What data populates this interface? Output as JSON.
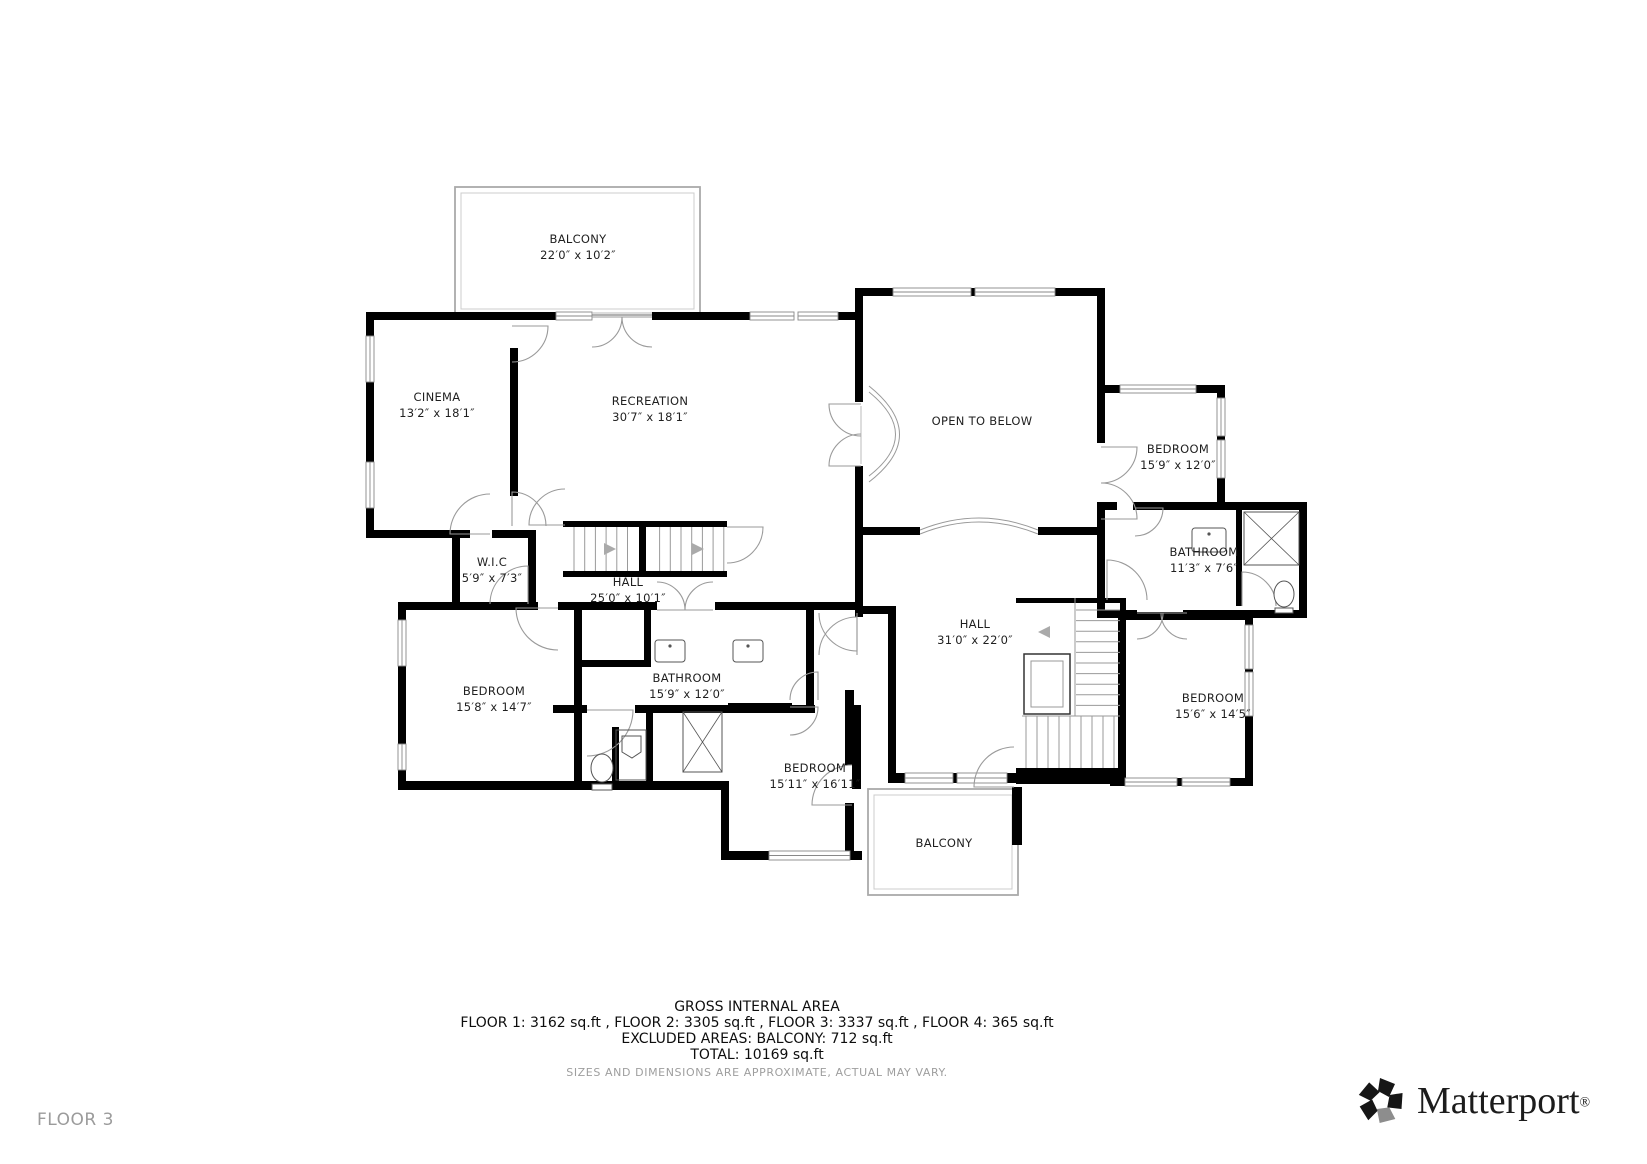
{
  "page": {
    "background": "#ffffff"
  },
  "floor_label": "FLOOR 3",
  "rooms": [
    {
      "id": "balcony-top",
      "name": "BALCONY",
      "dims": "22′0″ x 10′2″",
      "cx": 578,
      "y1": 243,
      "y2": 259
    },
    {
      "id": "cinema",
      "name": "CINEMA",
      "dims": "13′2″ x 18′1″",
      "cx": 437,
      "y1": 401,
      "y2": 417
    },
    {
      "id": "recreation",
      "name": "RECREATION",
      "dims": "30′7″ x 18′1″",
      "cx": 650,
      "y1": 405,
      "y2": 421
    },
    {
      "id": "open-to-below",
      "name": "OPEN TO BELOW",
      "dims": null,
      "cx": 982,
      "y1": 425,
      "y2": null
    },
    {
      "id": "bedroom-top-right",
      "name": "BEDROOM",
      "dims": "15′9″ x 12′0″",
      "cx": 1178,
      "y1": 453,
      "y2": 469
    },
    {
      "id": "wic",
      "name": "W.I.C",
      "dims": "5′9″ x 7′3″",
      "cx": 492,
      "y1": 566,
      "y2": 582
    },
    {
      "id": "hall-upper",
      "name": "HALL",
      "dims": "25′0″ x 10′1″",
      "cx": 628,
      "y1": 586,
      "y2": 602
    },
    {
      "id": "bathroom-top-right",
      "name": "BATHROOM",
      "dims": "11′3″ x 7′6″",
      "cx": 1204,
      "y1": 556,
      "y2": 572
    },
    {
      "id": "hall-main",
      "name": "HALL",
      "dims": "31′0″ x 22′0″",
      "cx": 975,
      "y1": 628,
      "y2": 644
    },
    {
      "id": "bedroom-left",
      "name": "BEDROOM",
      "dims": "15′8″ x 14′7″",
      "cx": 494,
      "y1": 695,
      "y2": 711
    },
    {
      "id": "bathroom-center",
      "name": "BATHROOM",
      "dims": "15′9″ x 12′0″",
      "cx": 687,
      "y1": 682,
      "y2": 698
    },
    {
      "id": "bedroom-bottom-right",
      "name": "BEDROOM",
      "dims": "15′6″ x 14′5″",
      "cx": 1213,
      "y1": 702,
      "y2": 718
    },
    {
      "id": "bedroom-bottom",
      "name": "BEDROOM",
      "dims": "15′11″ x 16′11″",
      "cx": 815,
      "y1": 772,
      "y2": 788
    },
    {
      "id": "balcony-bottom",
      "name": "BALCONY",
      "dims": null,
      "cx": 944,
      "y1": 847,
      "y2": null
    }
  ],
  "footer": {
    "title": "GROSS INTERNAL AREA",
    "line_floors": "FLOOR 1: 3162 sq.ft , FLOOR 2: 3305 sq.ft , FLOOR 3: 3337 sq.ft , FLOOR 4: 365 sq.ft",
    "line_excluded": "EXCLUDED AREAS: BALCONY: 712 sq.ft",
    "line_total": "TOTAL: 10169 sq.ft",
    "disclaimer": "SIZES AND DIMENSIONS ARE APPROXIMATE, ACTUAL MAY VARY."
  },
  "brand": {
    "name": "Matterport",
    "registered": "®",
    "logo_icon": "matterport-pinwheel",
    "colors": {
      "text": "#1c1c1c",
      "petal": "#161616",
      "petal_accent": "#8d8d8d"
    }
  },
  "colors": {
    "wall": "#000000",
    "door_arc": "#9a9a9a",
    "window": "#888888",
    "balcony_outline": "#aaaaaa",
    "stair_tread": "#9a9a9a",
    "fixture": "#555555",
    "label": "#1f1f1f",
    "muted_text": "#9b9b9b"
  }
}
